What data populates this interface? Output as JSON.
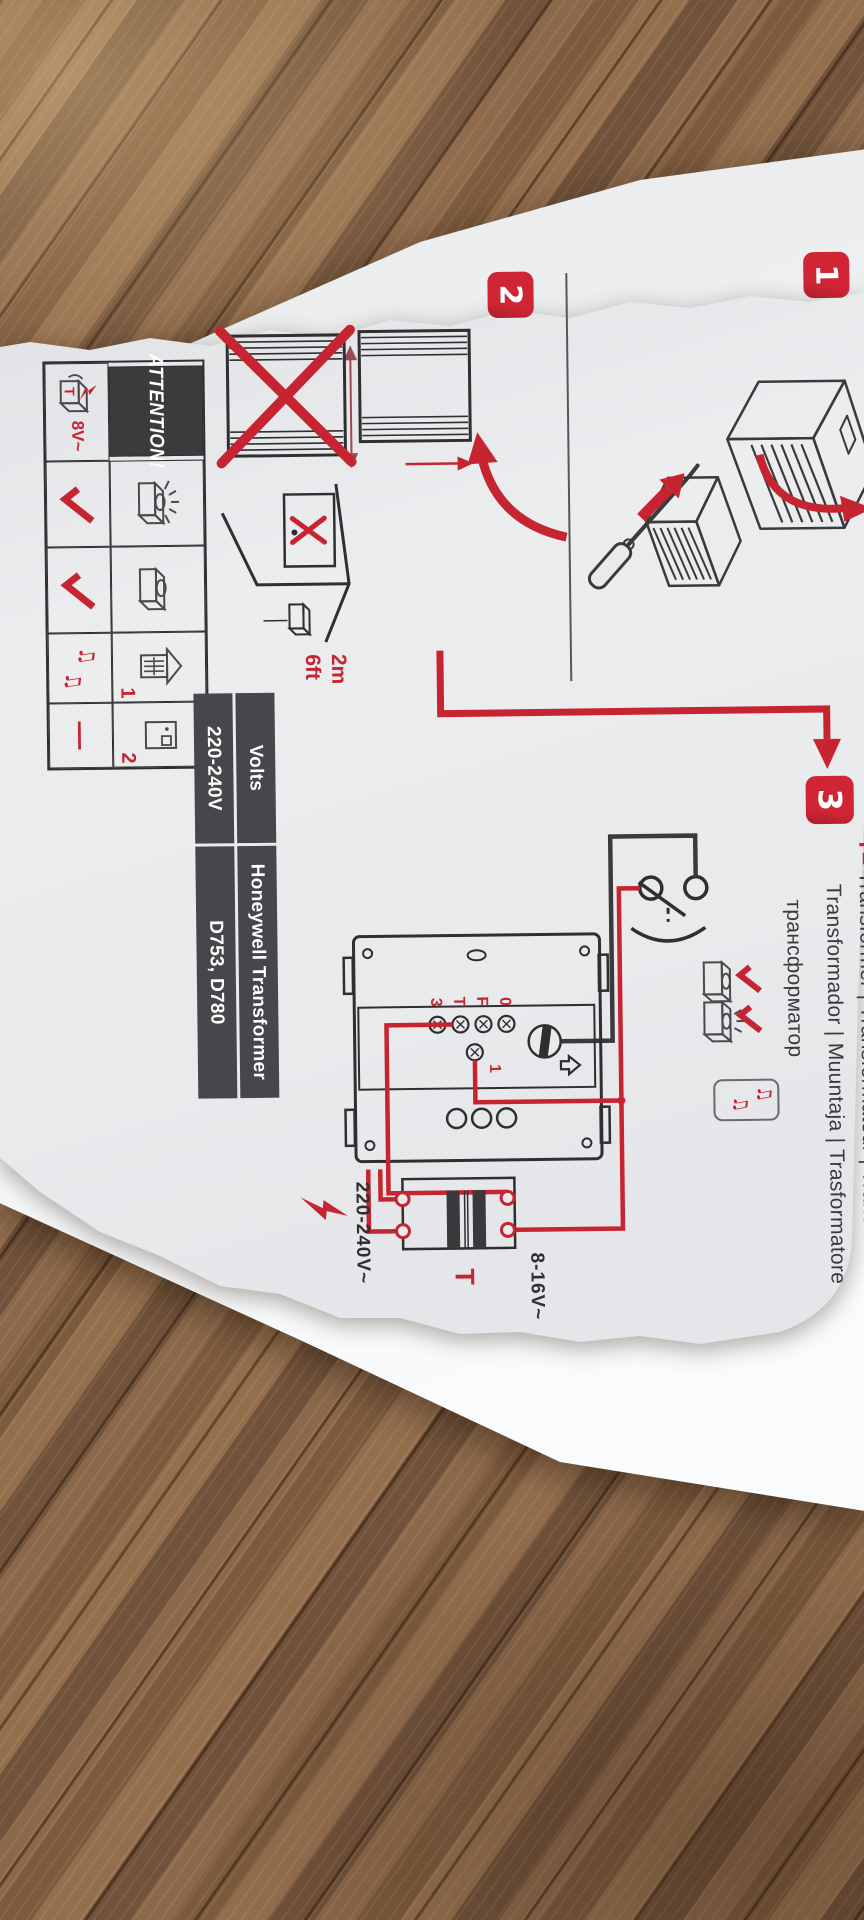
{
  "badges": {
    "step1": "1",
    "step2": "2",
    "step3": "3"
  },
  "step2": {
    "distance_m": "2m",
    "distance_ft": "6ft",
    "attention": {
      "title": "ATTENTION!",
      "transformer_letter": "T",
      "voltage": "8V~",
      "door_front_num": "1",
      "door_second_num": "2",
      "note": "♫",
      "dash": "—"
    }
  },
  "step3": {
    "t_prefix": "T=",
    "line1": "Transformer | Transformateur | Transformator",
    "line2": "Transformador | Muuntaja | Trasformatore",
    "line3": "трансформатор",
    "note": "♫",
    "terminals": {
      "t0": "0",
      "tf": "F",
      "tt": "T",
      "t3": "3",
      "wire1": "1"
    },
    "labels": {
      "primary": "220-240V~",
      "secondary": "8-16V~",
      "transformer": "T"
    },
    "table": {
      "volts_header": "Volts",
      "transformer_header": "Honeywell Transformer",
      "volts_value": "220-240V",
      "models_value": "D753, D780"
    }
  }
}
